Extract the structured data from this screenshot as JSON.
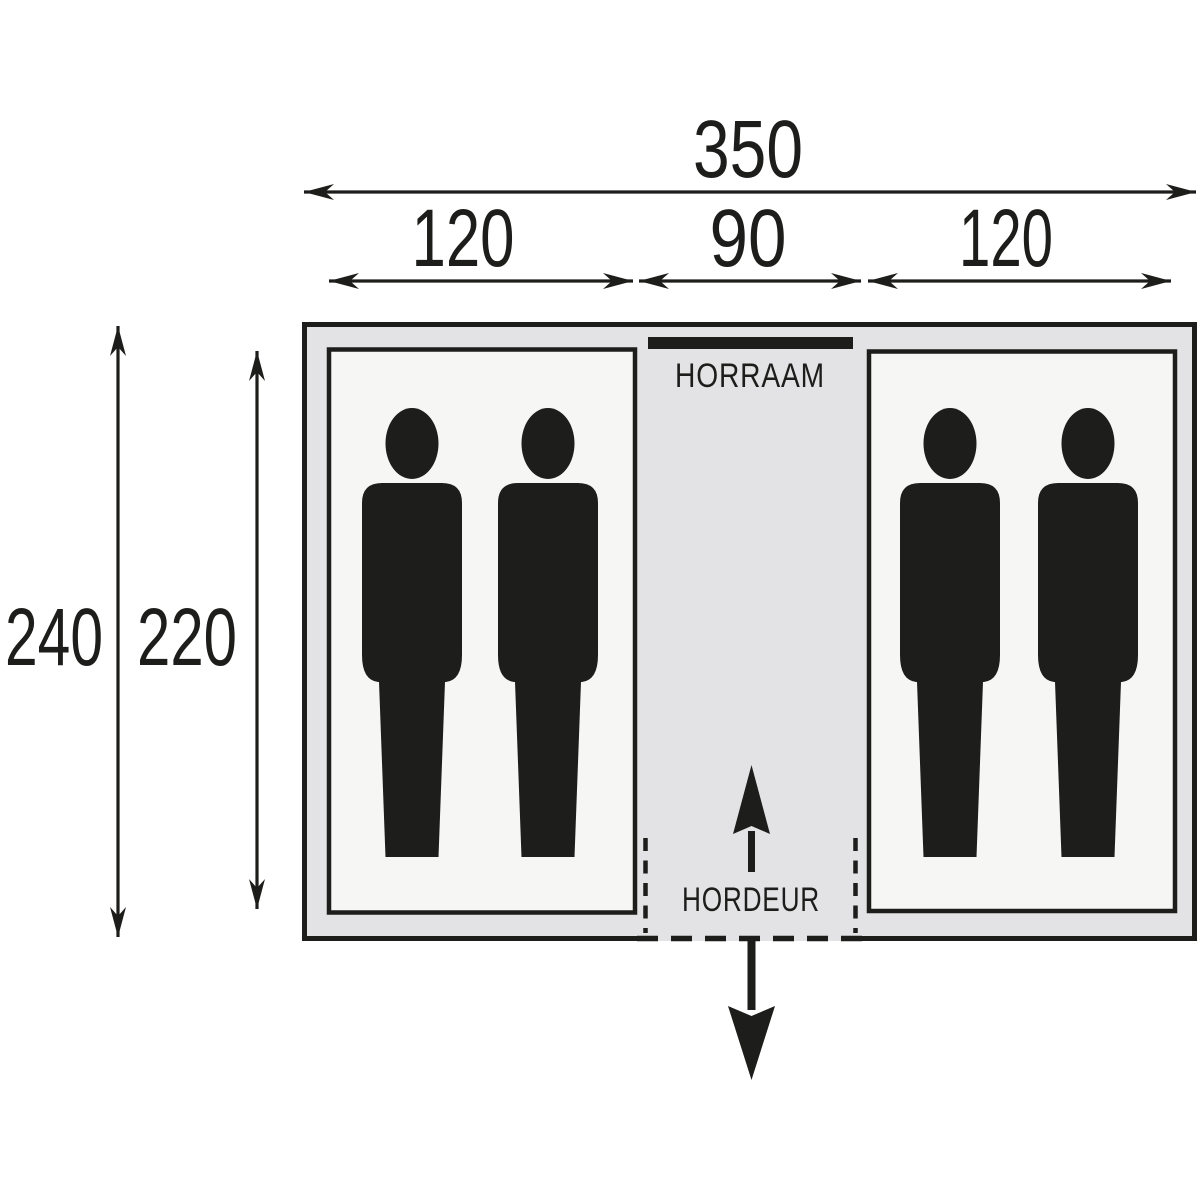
{
  "diagram": {
    "type": "tent-floorplan",
    "colors": {
      "line": "#1d1d1b",
      "tent_fill": "#e3e3e5",
      "cabin_fill": "#f6f6f5",
      "background": "#ffffff"
    },
    "dims": {
      "total_width": "350",
      "left_cabin_width": "120",
      "corridor_width": "90",
      "right_cabin_width": "120",
      "outer_depth": "240",
      "inner_depth": "220"
    },
    "labels": {
      "window": "HORRAAM",
      "door": "HORDEUR"
    },
    "cabins": {
      "left_persons": 2,
      "right_persons": 2
    }
  }
}
